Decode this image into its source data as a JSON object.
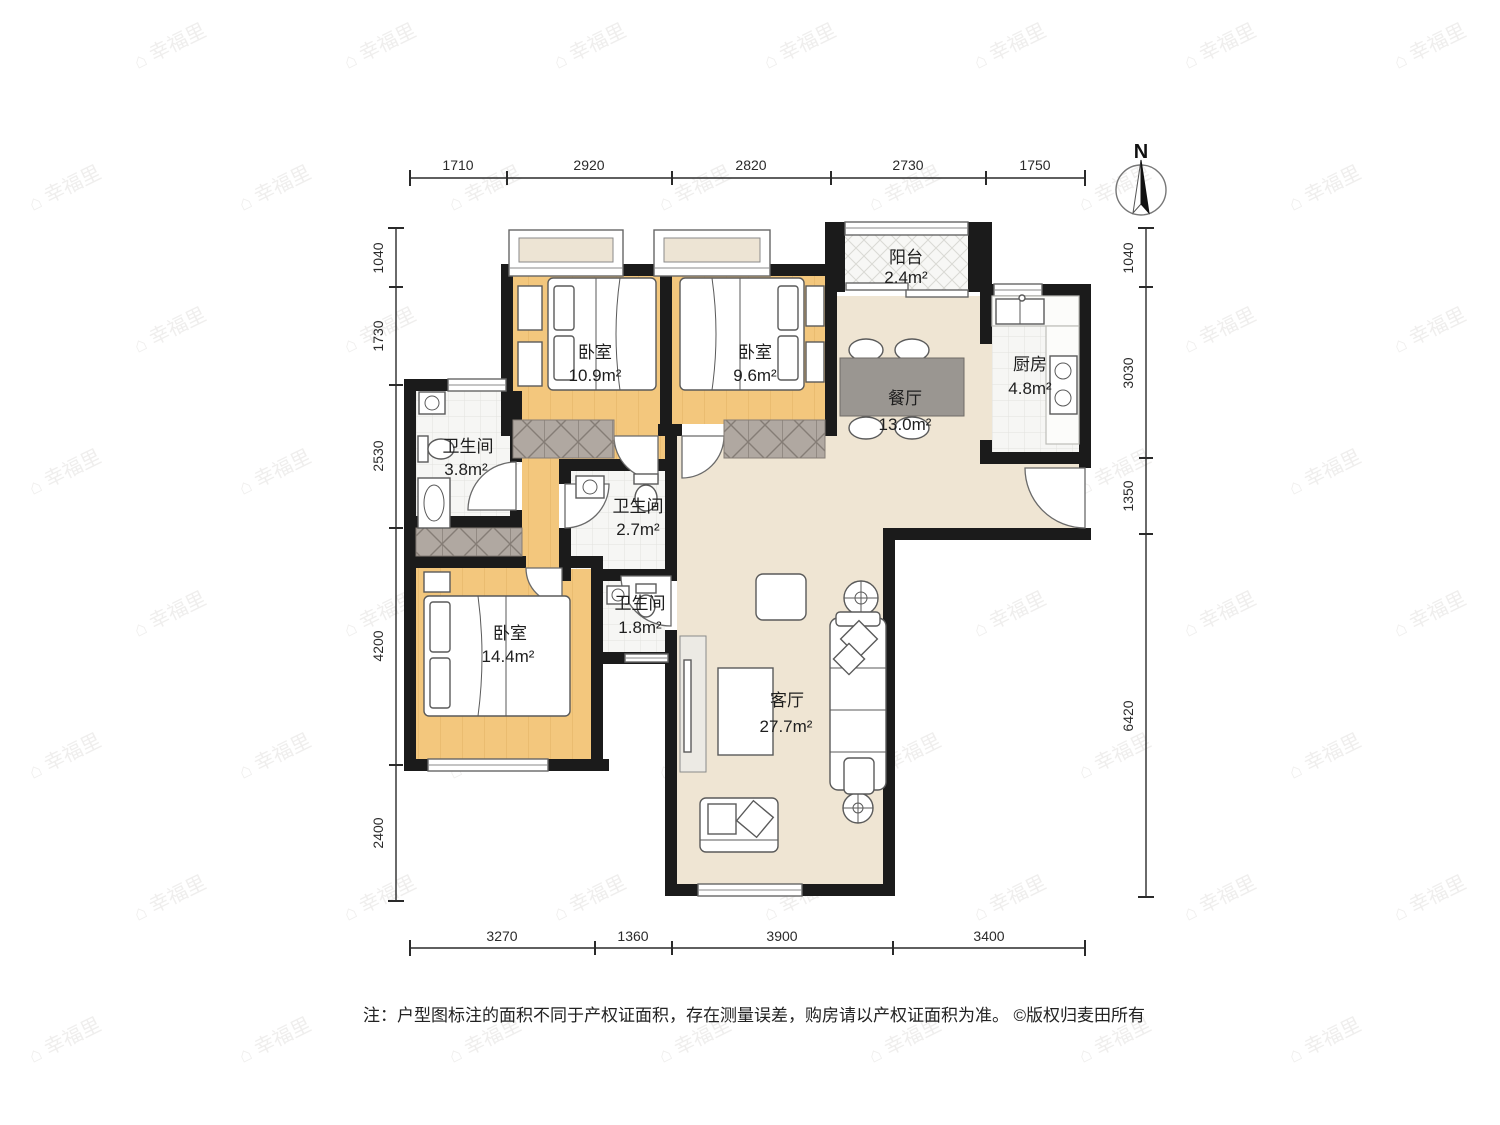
{
  "watermark": {
    "logo": "⌂",
    "text": "幸福里"
  },
  "compass": {
    "label": "N"
  },
  "dimensions": {
    "top": [
      "1710",
      "2920",
      "2820",
      "2730",
      "1750"
    ],
    "bottom": [
      "3270",
      "1360",
      "3900",
      "3400"
    ],
    "left": [
      "1040",
      "1730",
      "2530",
      "4200",
      "2400"
    ],
    "right": [
      "1040",
      "3030",
      "1350",
      "6420"
    ]
  },
  "rooms": {
    "balcony": {
      "name": "阳台",
      "area": "2.4m²"
    },
    "bedroom1": {
      "name": "卧室",
      "area": "10.9m²"
    },
    "bedroom2": {
      "name": "卧室",
      "area": "9.6m²"
    },
    "dining": {
      "name": "餐厅",
      "area": "13.0m²"
    },
    "kitchen": {
      "name": "厨房",
      "area": "4.8m²"
    },
    "bath1": {
      "name": "卫生间",
      "area": "3.8m²"
    },
    "bath2": {
      "name": "卫生间",
      "area": "2.7m²"
    },
    "bath3": {
      "name": "卫生间",
      "area": "1.8m²"
    },
    "bedroom3": {
      "name": "卧室",
      "area": "14.4m²"
    },
    "living": {
      "name": "客厅",
      "area": "27.7m²"
    }
  },
  "footer": {
    "note": "注：户型图标注的面积不同于产权证面积，存在测量误差，购房请以产权证面积为准。",
    "copyright": "©版权归麦田所有"
  },
  "colors": {
    "wall": "#1b1b1b",
    "wood_floor": "#F3C77D",
    "cream_floor": "#EFE5D3",
    "tile_floor": "#F6F6F4",
    "wardrobe_hatch": "#B0A8A1",
    "dining_table": "#9A9691"
  }
}
